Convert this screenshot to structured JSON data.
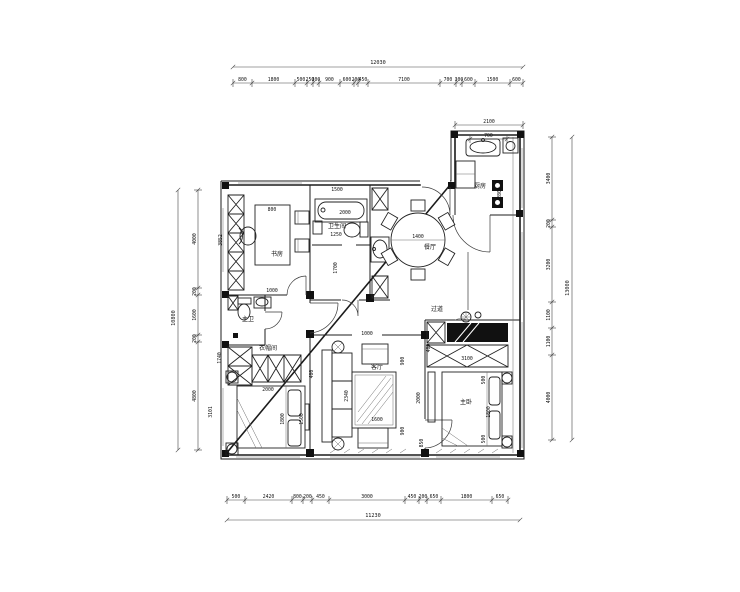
{
  "meta": {
    "title": "户型平面图"
  },
  "rooms": [
    {
      "t": "书房",
      "x": 277,
      "y": 256
    },
    {
      "t": "卫生间",
      "x": 337,
      "y": 228,
      "s": 4.4
    },
    {
      "t": "主卫",
      "x": 248,
      "y": 321,
      "s": 4.8
    },
    {
      "t": "衣帽间",
      "x": 268,
      "y": 350,
      "s": 4.8
    },
    {
      "t": "过道",
      "x": 437,
      "y": 311,
      "s": 5
    },
    {
      "t": "餐厅",
      "x": 430,
      "y": 249,
      "s": 4.8
    },
    {
      "t": "厨房",
      "x": 480,
      "y": 188,
      "s": 4.8
    },
    {
      "t": "客厅",
      "x": 377,
      "y": 369,
      "s": 4.8
    },
    {
      "t": "主卧",
      "x": 466,
      "y": 404,
      "s": 4.8
    }
  ],
  "dims": [
    {
      "t": "800",
      "x": 272,
      "y": 211
    },
    {
      "t": "1000",
      "x": 272,
      "y": 292
    },
    {
      "t": "3852",
      "x": 222,
      "y": 240,
      "r": 1
    },
    {
      "t": "1740",
      "x": 221,
      "y": 358,
      "r": 1
    },
    {
      "t": "3101",
      "x": 212,
      "y": 412,
      "r": 1
    },
    {
      "t": "1500",
      "x": 337,
      "y": 191
    },
    {
      "t": "2000",
      "x": 345,
      "y": 214
    },
    {
      "t": "1250",
      "x": 336,
      "y": 236
    },
    {
      "t": "1700",
      "x": 337,
      "y": 268,
      "r": 1
    },
    {
      "t": "1400",
      "x": 418,
      "y": 238
    },
    {
      "t": "2800",
      "x": 501,
      "y": 193,
      "r": 1
    },
    {
      "t": "1000",
      "x": 367,
      "y": 335
    },
    {
      "t": "2340",
      "x": 348,
      "y": 396,
      "r": 1
    },
    {
      "t": "2000",
      "x": 420,
      "y": 398,
      "r": 1
    },
    {
      "t": "900",
      "x": 404,
      "y": 361,
      "r": 1
    },
    {
      "t": "900",
      "x": 404,
      "y": 431,
      "r": 1
    },
    {
      "t": "850",
      "x": 423,
      "y": 443,
      "r": 1
    },
    {
      "t": "400",
      "x": 430,
      "y": 348,
      "r": 1
    },
    {
      "t": "1600",
      "x": 377,
      "y": 421
    },
    {
      "t": "2000",
      "x": 268,
      "y": 391
    },
    {
      "t": "1800",
      "x": 284,
      "y": 419,
      "r": 1
    },
    {
      "t": "1500",
      "x": 303,
      "y": 419,
      "r": 1
    },
    {
      "t": "400",
      "x": 313,
      "y": 374,
      "r": 1
    },
    {
      "t": "3100",
      "x": 467,
      "y": 360
    },
    {
      "t": "1800",
      "x": 490,
      "y": 412,
      "r": 1
    },
    {
      "t": "500",
      "x": 485,
      "y": 380,
      "r": 1
    },
    {
      "t": "500",
      "x": 485,
      "y": 439,
      "r": 1
    }
  ],
  "chains": [
    {
      "d": "h",
      "at": 83,
      "ticks": [
        233,
        252,
        295,
        307,
        313,
        319,
        340,
        354,
        358,
        368,
        440,
        456,
        462,
        475,
        510,
        523
      ],
      "values": [
        "800",
        "1800",
        "500",
        "250",
        "300",
        "900",
        "600",
        "200",
        "450",
        "7100",
        "700",
        "300",
        "600",
        "1500",
        "600"
      ]
    },
    {
      "d": "h",
      "at": 500,
      "ticks": [
        227,
        245,
        292,
        303,
        312,
        329,
        405,
        419,
        427,
        441,
        492,
        508
      ],
      "values": [
        "500",
        "2420",
        "800",
        "200",
        "450",
        "3000",
        "450",
        "200",
        "650",
        "1800",
        "650"
      ]
    },
    {
      "d": "v",
      "at": 198,
      "ticks": [
        190,
        288,
        295,
        335,
        342,
        450
      ],
      "values": [
        "4000",
        "200",
        "1600",
        "200",
        "4800"
      ]
    },
    {
      "d": "v",
      "at": 552,
      "ticks": [
        137,
        220,
        227,
        302,
        328,
        355,
        440
      ],
      "values": [
        "3400",
        "200",
        "3200",
        "1100",
        "1100",
        "4000"
      ]
    },
    {
      "d": "h",
      "at": 125,
      "ticks": [
        455,
        523
      ],
      "values": [
        "2100"
      ]
    },
    {
      "d": "h",
      "at": 139,
      "ticks": [
        470,
        507
      ],
      "values": [
        "700"
      ]
    }
  ],
  "totals": [
    {
      "d": "h",
      "at": 67,
      "from": 233,
      "to": 523,
      "label": "12030",
      "lx": 378,
      "ly": 64
    },
    {
      "d": "h",
      "at": 520,
      "from": 227,
      "to": 520,
      "label": "11230",
      "lx": 373,
      "ly": 517
    },
    {
      "d": "v",
      "at": 178,
      "from": 190,
      "to": 450,
      "label": "10800",
      "lx": 175,
      "ly": 318
    },
    {
      "d": "v",
      "at": 572,
      "from": 137,
      "to": 440,
      "label": "13000",
      "lx": 569,
      "ly": 288
    }
  ]
}
